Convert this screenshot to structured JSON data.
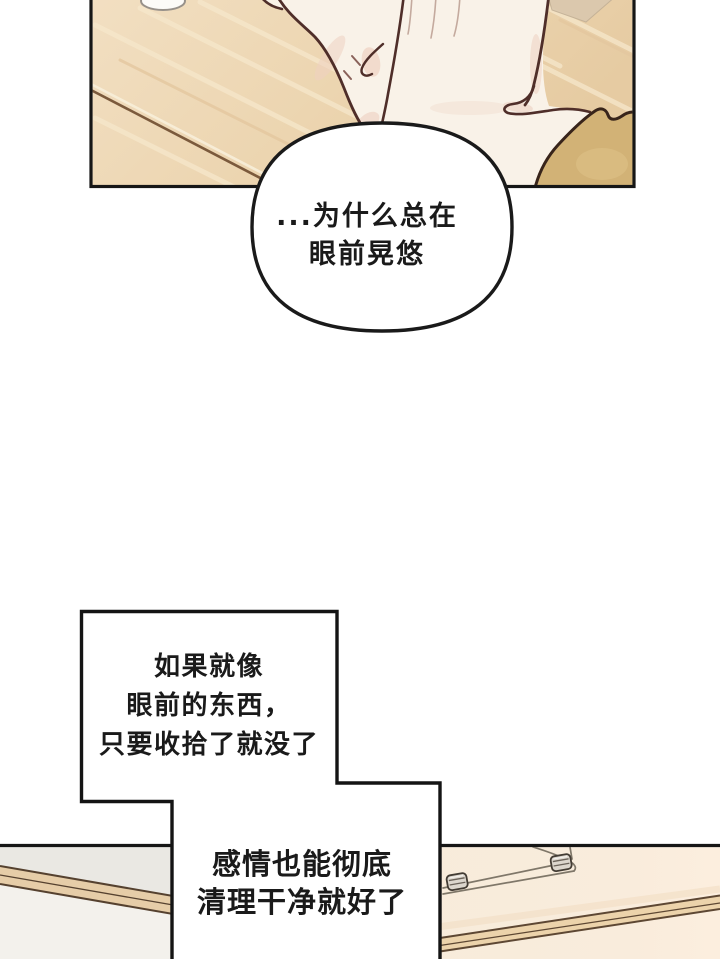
{
  "page": {
    "type": "webtoon-comic-page",
    "width": 720,
    "height": 959,
    "background": "#ffffff"
  },
  "speech_bubble": {
    "lines": [
      "...为什么总在",
      "眼前晃悠"
    ],
    "fill": "#ffffff",
    "stroke": "#1a1a1a"
  },
  "caption_box_top": {
    "lines": [
      "如果就像",
      "眼前的东西，",
      "只要收拾了就没了"
    ]
  },
  "caption_box_bottom": {
    "lines": [
      "感情也能彻底",
      "清理干净就好了"
    ]
  },
  "palette": {
    "text_color": "#1a1a1a",
    "panel_border": "#161616",
    "wood_floor": "#eed9ba",
    "floor_seam": "#7b5a3c",
    "skin": "#f9f2e8",
    "skin_outline": "#4f2e29",
    "skin_shadow": "#ecccbb",
    "sleeve_khaki": "#d2b276",
    "sleeve_outline": "#38241a",
    "wall_gray": "#eae8e3",
    "wood_edge": "#e6cda8",
    "wood_edge_line": "#55412f",
    "desk_room_cream": "#f8ecdb",
    "glass_line": "#7f7769",
    "clamp_metal": "#dcd6cd"
  }
}
